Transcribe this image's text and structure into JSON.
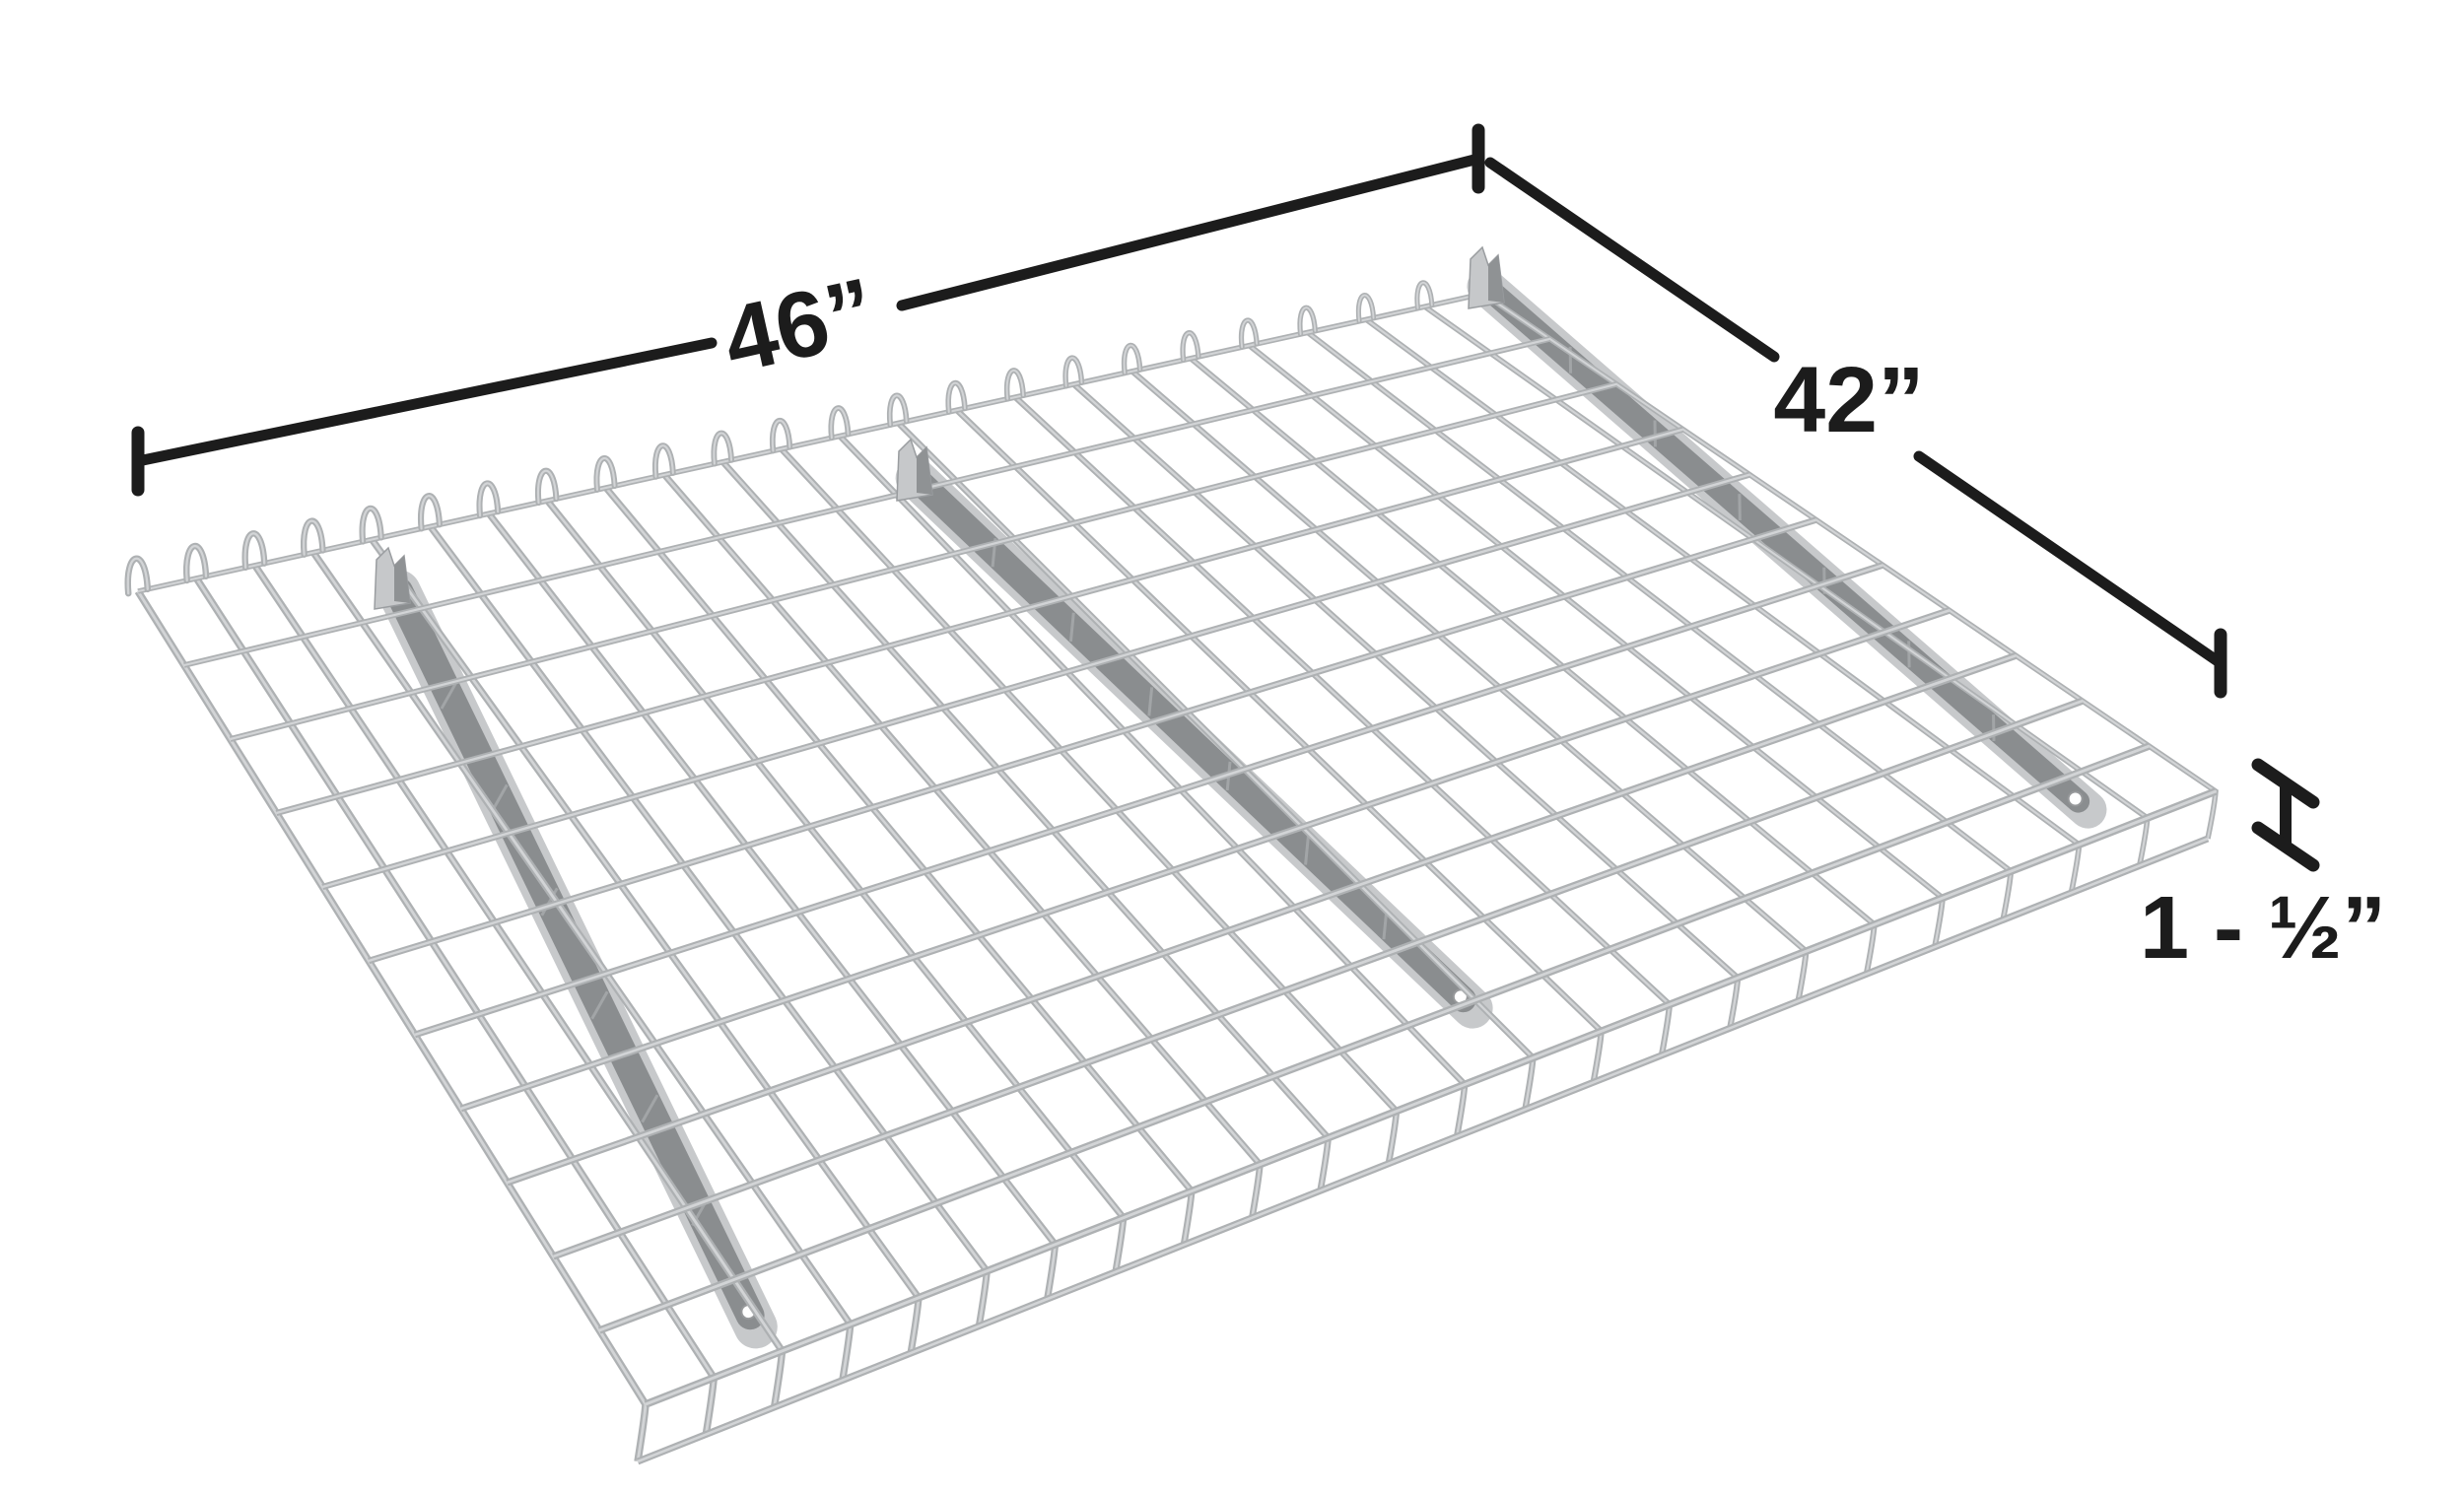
{
  "figure": {
    "dimensions": {
      "width_label": "46”",
      "depth_label": "42”",
      "height_label": "1 - ½”"
    },
    "colors": {
      "dimension": "#1c1c1c",
      "wire": "#aeb1b3",
      "wire_light": "#d2d4d6",
      "channel_wall": "#c7c9cb",
      "channel_interior": "#8a8d8f",
      "channel_streak": "#a2a5a7",
      "channel_flag": "#c6c8ca",
      "channel_flag_shade": "#8f9294",
      "hole_ring": "#96989a",
      "background": "#ffffff"
    },
    "mesh": {
      "cross_wires": 24,
      "long_wires": 12,
      "support_channels": 3
    }
  }
}
